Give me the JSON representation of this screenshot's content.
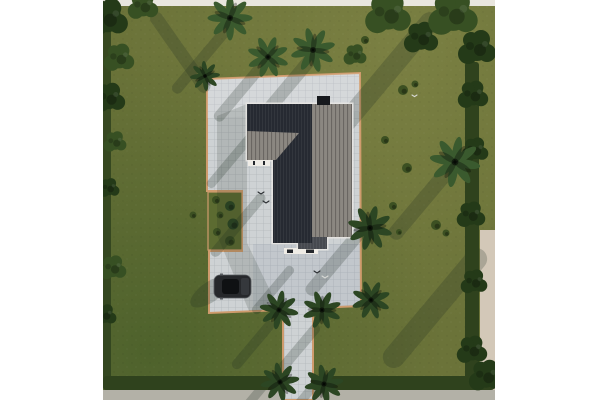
{
  "scene": {
    "kind": "aerial-3d-architectural-render",
    "subject": "single-family house with dark roof on landscaped lot",
    "objects": [
      "house-roof",
      "paver-plaza",
      "entry-walkway",
      "garden-bed",
      "parked-car",
      "palm-trees",
      "shade-trees",
      "shrubs",
      "lawn",
      "perimeter-hedge",
      "birds"
    ],
    "counts": {
      "walkway-palms": 4,
      "plaza-edge-palms": 2,
      "top-lawn-palms": 3,
      "right-lawn-palms": 1
    }
  },
  "palette": {
    "page-bg": "#ffffff",
    "lawn": "#6b7339",
    "top-wall": "#e9e6de",
    "outer-right": "#d3c8b8",
    "outer-bottom": "#b3b1a7",
    "hedge": "#2f421d",
    "tree": "#375023",
    "tree-dark": "#243a18",
    "palm": "#3a5a2e",
    "palm-dark": "#2c4623",
    "shrub": "#3c5022",
    "paver": "#ced2d4",
    "paver-line": "#b2b7bb",
    "edge-orange": "#cf9b6d",
    "garden": "#5c6b31",
    "roof-dark": "#262a32",
    "roof-step": "#474a50",
    "roof-lit": "#8b8781",
    "chimney": "#17191d",
    "eave": "#e9e8e4",
    "wall": "#efece6",
    "window": "#23262b",
    "shadow": "#1c2a20",
    "car-body": "#26282b",
    "car-glass": "#0f1113",
    "car-hood": "#35383c",
    "car-trim": "#595d61",
    "bird": "#2a2d31",
    "bird-light": "#d8d9d6"
  }
}
